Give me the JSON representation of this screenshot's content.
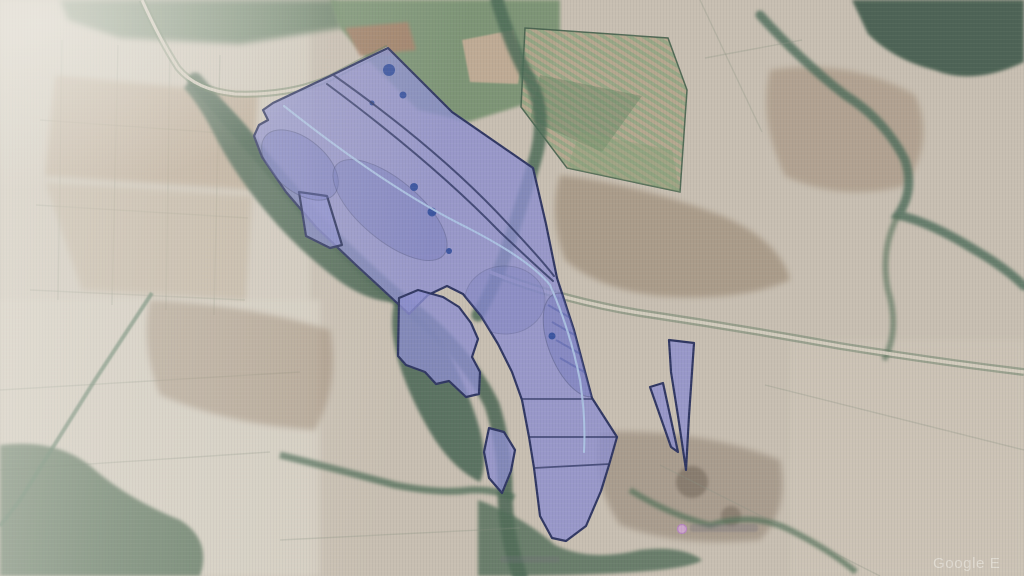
{
  "window": {
    "width": 1024,
    "height": 576
  },
  "watermark": {
    "text": "Google E"
  },
  "map": {
    "view": "satellite",
    "overlay": {
      "parcel_fill": "#868ad2",
      "parcel_stroke": "#1f2859",
      "track_color": "#a9c3e8",
      "pond_color": "#2c4a9e",
      "parcel_count": 6
    },
    "marker": {
      "color": "#d3a6d6"
    },
    "terrain": {
      "base": "#c8bfb1",
      "field_pale": "#d6d0c3",
      "field_brown": "#a98f73",
      "field_red_brown": "#a57a62",
      "field_green": "#6d8c67",
      "forest": "#3c5c49",
      "road": "#dad3c4"
    }
  }
}
